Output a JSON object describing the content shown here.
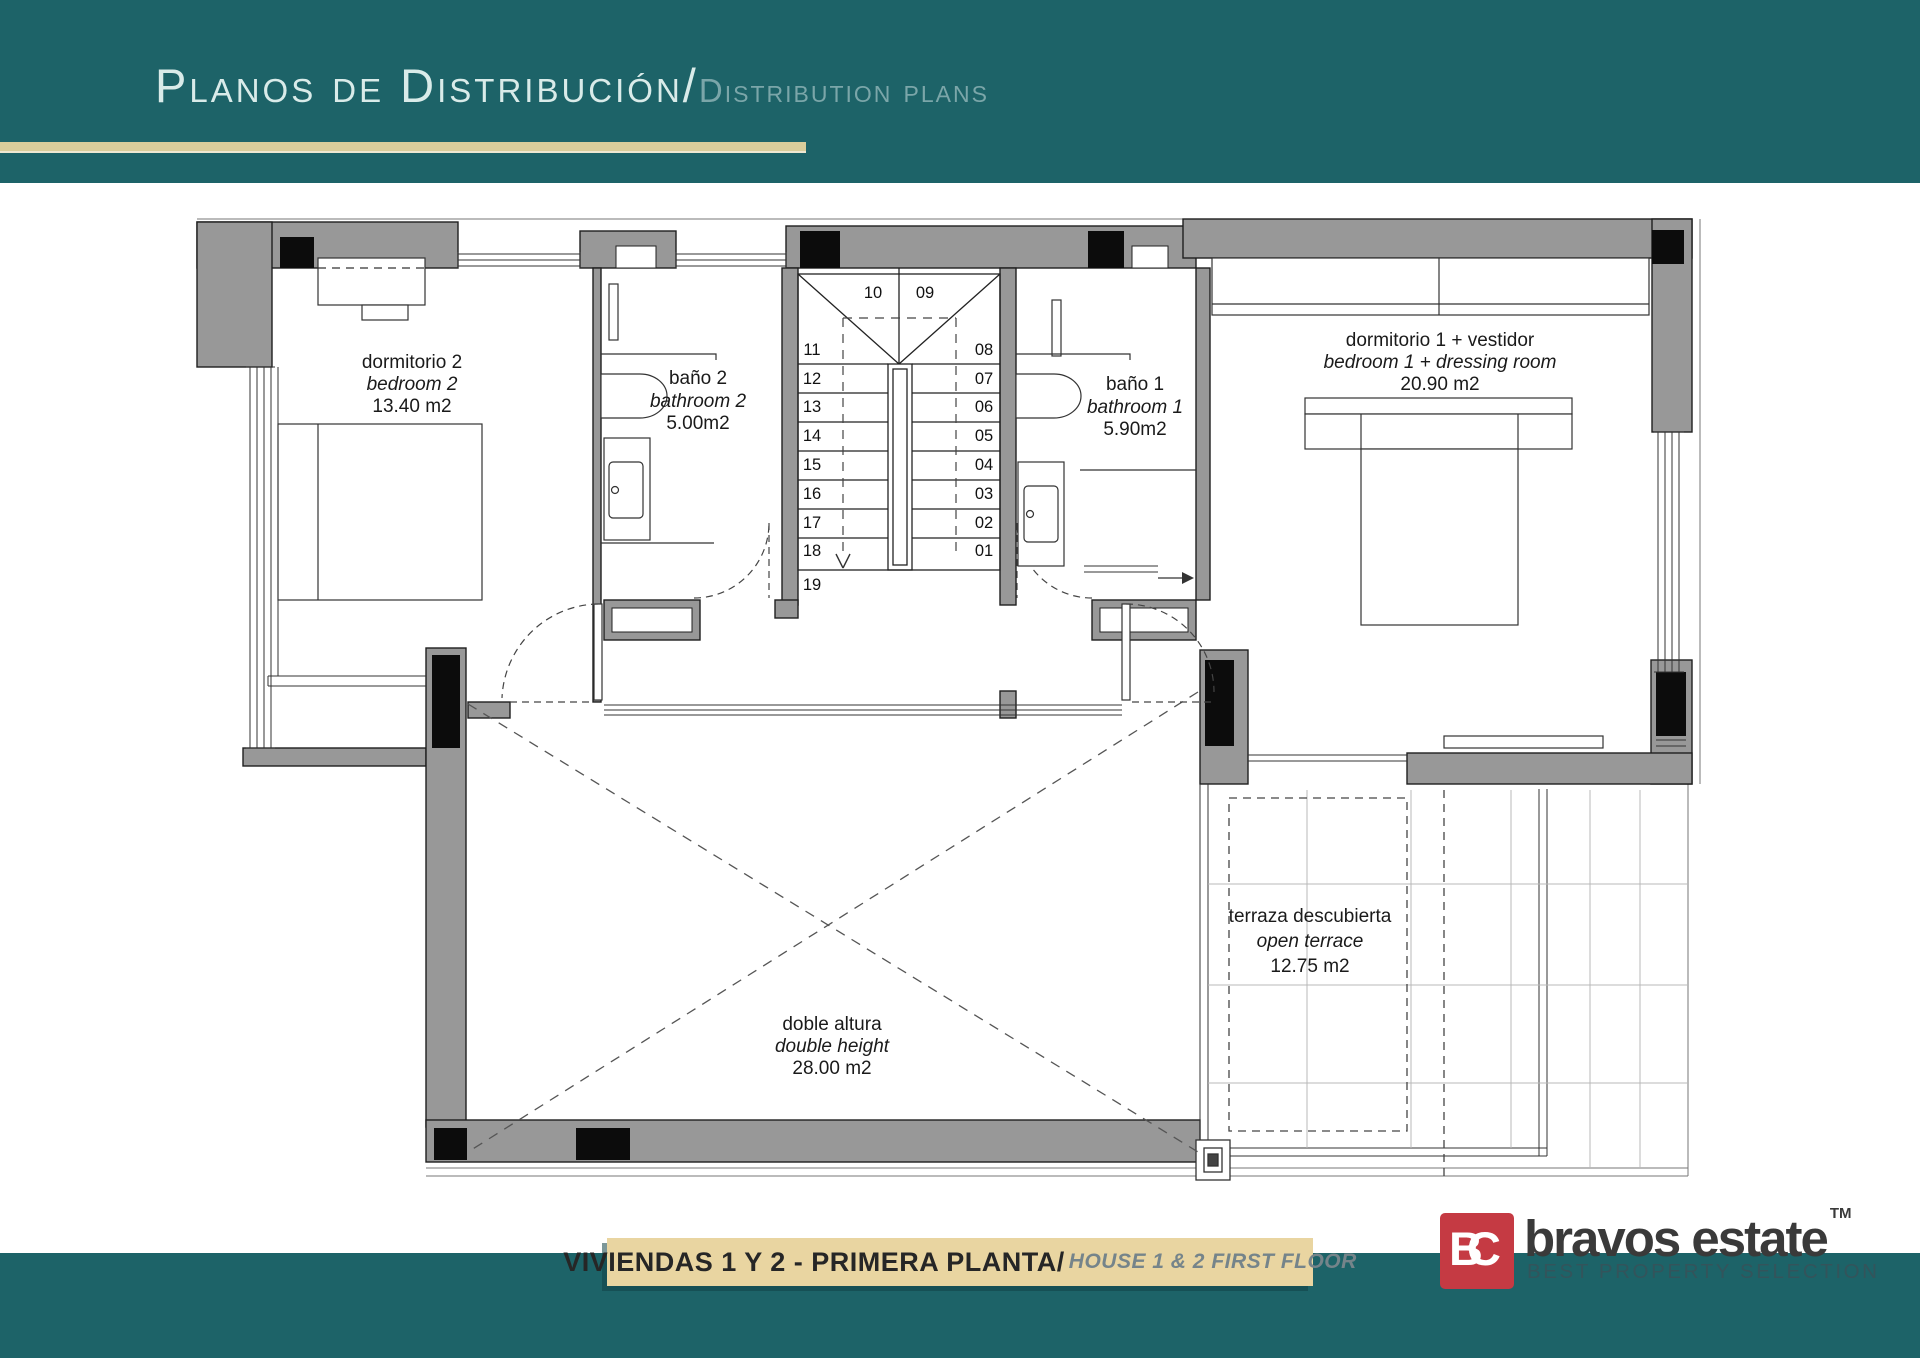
{
  "header": {
    "title_primary": "Planos de Distribución/",
    "title_secondary": "Distribution plans"
  },
  "plan": {
    "rooms": [
      {
        "id": "bedroom2",
        "name": "dormitorio 2",
        "name_en": "bedroom 2",
        "area": "13.40 m2"
      },
      {
        "id": "bathroom2",
        "name": "baño 2",
        "name_en": "bathroom 2",
        "area": "5.00m2"
      },
      {
        "id": "bathroom1",
        "name": "baño 1",
        "name_en": "bathroom 1",
        "area": "5.90m2"
      },
      {
        "id": "bedroom1",
        "name": "dormitorio 1 + vestidor",
        "name_en": "bedroom 1 + dressing room",
        "area": "20.90 m2"
      },
      {
        "id": "terrace",
        "name": "terraza descubierta",
        "name_en": "open terrace",
        "area": "12.75 m2"
      },
      {
        "id": "void",
        "name": "doble altura",
        "name_en": "double height",
        "area": "28.00 m2"
      }
    ],
    "stairs": {
      "top": [
        "10",
        "09"
      ],
      "left": [
        "11",
        "12",
        "13",
        "14",
        "15",
        "16",
        "17",
        "18",
        "19"
      ],
      "right": [
        "08",
        "07",
        "06",
        "05",
        "04",
        "03",
        "02",
        "01"
      ]
    }
  },
  "footer": {
    "banner_primary": "VIVIENDAS 1 Y 2 - PRIMERA PLANTA/",
    "banner_secondary": "HOUSE 1 & 2 FIRST FLOOR"
  },
  "logo": {
    "initials": "BC",
    "brand": "bravos estate",
    "trademark": "TM",
    "tagline": "BEST PROPERTY SELECTION"
  },
  "colors": {
    "teal": "#1d6368",
    "gold": "#d9cd9b",
    "banner_tan": "#e9d5a1",
    "logo_red": "#c53a43",
    "wall_gray": "#989898"
  }
}
